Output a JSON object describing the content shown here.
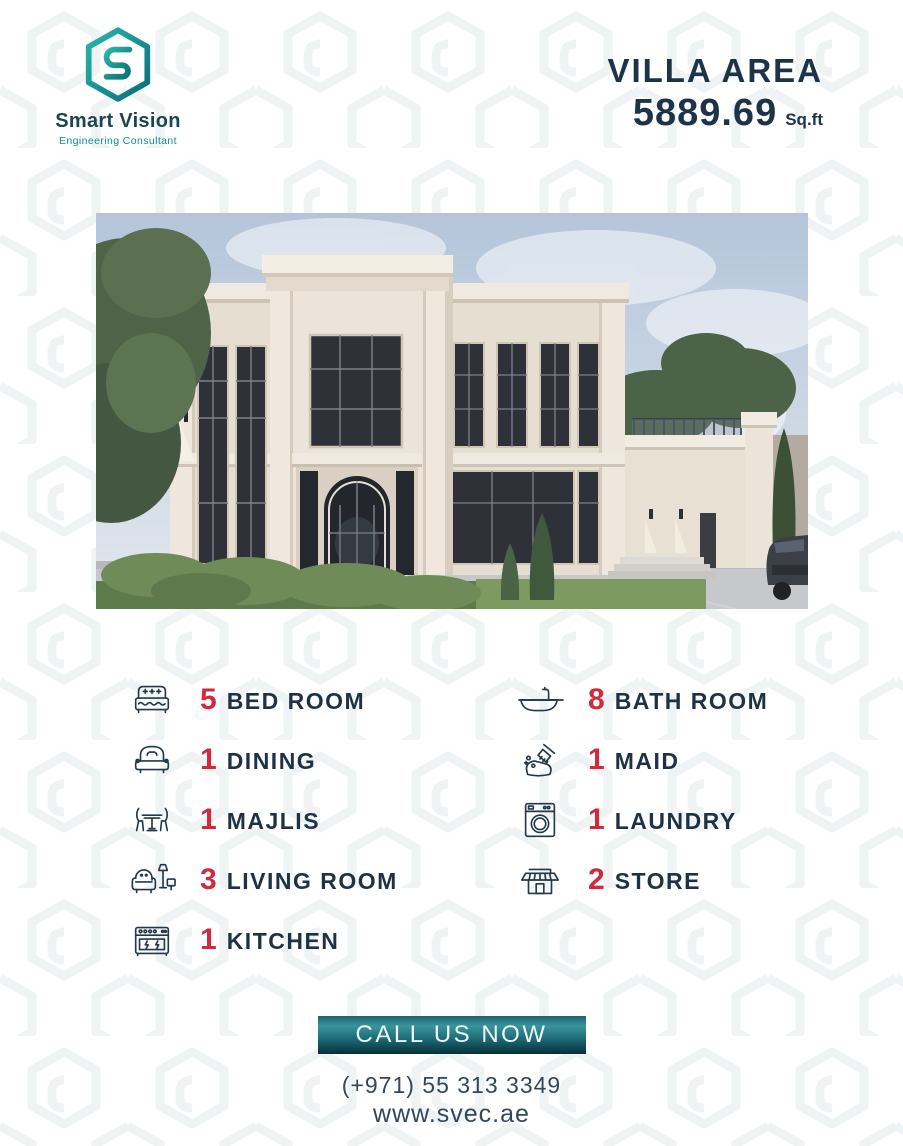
{
  "brand": {
    "name": "Smart Vision",
    "tagline": "Engineering Consultant",
    "logo_icon": "hexagon-s-logo",
    "teal": "#0f8e93",
    "dark": "#1c4553"
  },
  "header": {
    "area_label": "VILLA AREA",
    "area_value": "5889.69",
    "area_unit": "Sq.ft"
  },
  "features": [
    {
      "count": "5",
      "label": "BED ROOM",
      "icon": "bed-icon"
    },
    {
      "count": "1",
      "label": "MAJLIS",
      "icon": "sofa-icon"
    },
    {
      "count": "1",
      "label": "DINING",
      "icon": "dining-table-icon"
    },
    {
      "count": "3",
      "label": "LIVING ROOM",
      "icon": "armchair-lamp-icon"
    },
    {
      "count": "1",
      "label": "KITCHEN",
      "icon": "stove-icon"
    },
    {
      "count": "8",
      "label": "BATH ROOM",
      "icon": "bathtub-icon"
    },
    {
      "count": "1",
      "label": "MAID",
      "icon": "cleaning-brush-icon"
    },
    {
      "count": "1",
      "label": "LAUNDRY",
      "icon": "washing-machine-icon"
    },
    {
      "count": "2",
      "label": "STORE",
      "icon": "shop-icon"
    }
  ],
  "cta": {
    "button_label": "CALL US NOW",
    "phone": "(+971) 55 313 3349",
    "website": "www.svec.ae"
  },
  "colors": {
    "accent_red": "#d2293c",
    "text_navy": "#1e3247",
    "button_teal_light": "#3a949c",
    "button_teal_dark": "#082f38"
  }
}
